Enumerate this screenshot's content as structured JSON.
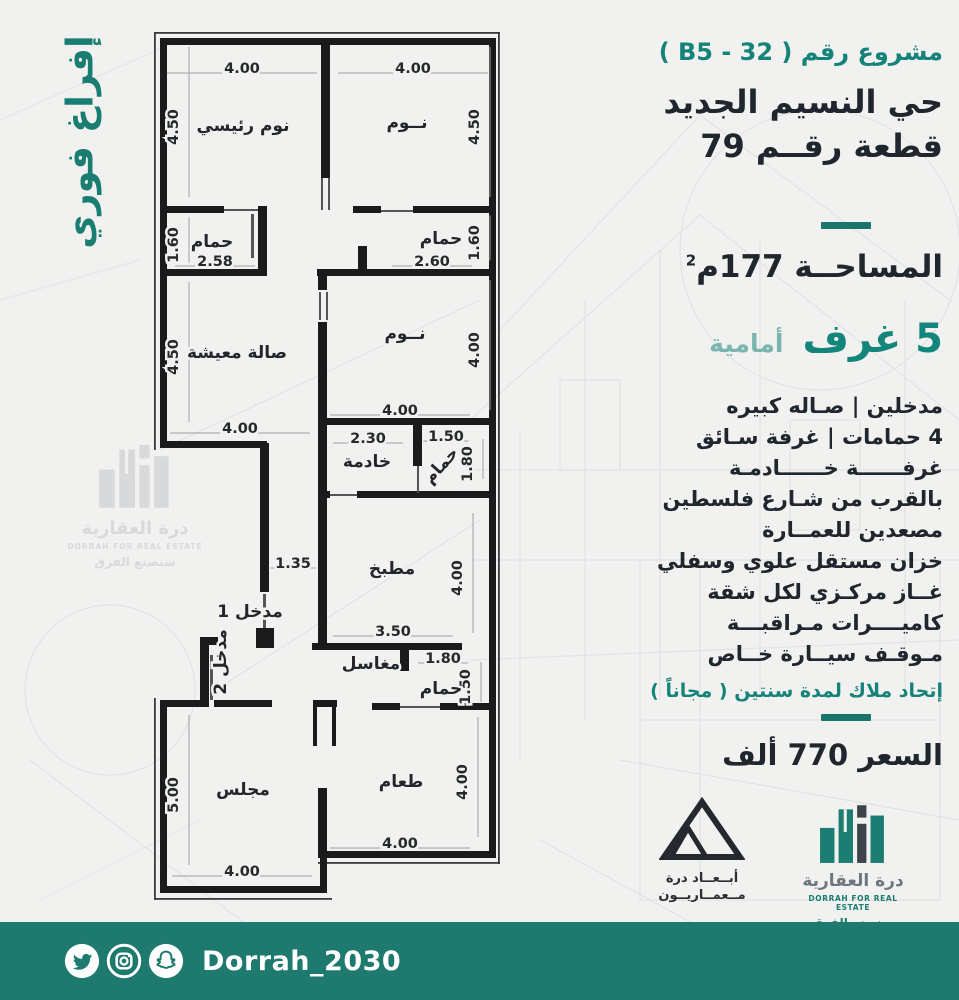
{
  "banner": {
    "text": "إفراغ فوري"
  },
  "panel": {
    "project_no": "مشروع رقم ( B5 - 32 )",
    "district": "حي النسيم الجديد",
    "plot": "قطعة رقــم 79",
    "area": "المساحــة 177م",
    "area_sup": "2",
    "rooms_count": "5 غرف",
    "rooms_side": "أمامية",
    "features": [
      "مدخلين  |  صـاله كبيره",
      "4 حمامات | غرفة سـائق",
      "غرفــــــة خــــــادمـة",
      "بالقرب من شـارع فلسطين",
      "مصعدين  للعمــارة",
      "خزان مستقل علوي وسفلي",
      "غــاز مركـزي لكل شقة",
      "كاميــــرات مـراقبـــة",
      "مـوقـف سيــارة خــاص"
    ],
    "note": "إتحاد ملاك لمدة سنتين ( مجاناً )",
    "price": "السعر 770 ألف"
  },
  "floorplan": {
    "rooms": [
      {
        "label": "نوم رئيسي",
        "x": 243,
        "y": 125,
        "rot": 0
      },
      {
        "label": "نــوم",
        "x": 407,
        "y": 122,
        "rot": 0
      },
      {
        "label": "حمام",
        "x": 212,
        "y": 241,
        "rot": 0
      },
      {
        "label": "حمام",
        "x": 441,
        "y": 238,
        "rot": 0
      },
      {
        "label": "صالة معيشة",
        "x": 237,
        "y": 352,
        "rot": 0
      },
      {
        "label": "نــوم",
        "x": 405,
        "y": 333,
        "rot": 0
      },
      {
        "label": "خادمة",
        "x": 367,
        "y": 461,
        "rot": 0
      },
      {
        "label": "حمام",
        "x": 445,
        "y": 463,
        "rot": -48
      },
      {
        "label": "مطبخ",
        "x": 392,
        "y": 568,
        "rot": 0
      },
      {
        "label": "مدخل 1",
        "x": 250,
        "y": 611,
        "rot": 0
      },
      {
        "label": "مدخل 2",
        "x": 226,
        "y": 656,
        "rot": -90
      },
      {
        "label": "مغاسل",
        "x": 371,
        "y": 663,
        "rot": 0
      },
      {
        "label": "حمام",
        "x": 441,
        "y": 688,
        "rot": 0
      },
      {
        "label": "مجلس",
        "x": 243,
        "y": 789,
        "rot": 0
      },
      {
        "label": "طعام",
        "x": 401,
        "y": 781,
        "rot": 0
      }
    ],
    "dims": [
      {
        "v": "4.00",
        "x": 242,
        "y": 68,
        "rot": 0,
        "len": 150
      },
      {
        "v": "4.00",
        "x": 413,
        "y": 68,
        "rot": 0,
        "len": 150
      },
      {
        "v": "4.50",
        "x": 178,
        "y": 122,
        "rot": -90,
        "len": 150
      },
      {
        "v": "4.50",
        "x": 479,
        "y": 122,
        "rot": -90,
        "len": 150
      },
      {
        "v": "1.60",
        "x": 178,
        "y": 240,
        "rot": -90,
        "len": 45
      },
      {
        "v": "2.58",
        "x": 215,
        "y": 261,
        "rot": 0,
        "len": 80
      },
      {
        "v": "1.60",
        "x": 479,
        "y": 238,
        "rot": -90,
        "len": 45
      },
      {
        "v": "2.60",
        "x": 432,
        "y": 261,
        "rot": 0,
        "len": 80
      },
      {
        "v": "4.50",
        "x": 178,
        "y": 352,
        "rot": -90,
        "len": 140
      },
      {
        "v": "4.00",
        "x": 479,
        "y": 345,
        "rot": -90,
        "len": 130
      },
      {
        "v": "4.00",
        "x": 240,
        "y": 428,
        "rot": 0,
        "len": 140
      },
      {
        "v": "4.00",
        "x": 400,
        "y": 410,
        "rot": 0,
        "len": 140
      },
      {
        "v": "2.30",
        "x": 368,
        "y": 438,
        "rot": 0,
        "len": 70
      },
      {
        "v": "1.50",
        "x": 446,
        "y": 436,
        "rot": 0,
        "len": 45
      },
      {
        "v": "1.80",
        "x": 472,
        "y": 459,
        "rot": -90,
        "len": 40
      },
      {
        "v": "1.35",
        "x": 293,
        "y": 563,
        "rot": 0,
        "len": 45
      },
      {
        "v": "4.00",
        "x": 462,
        "y": 573,
        "rot": -90,
        "len": 120
      },
      {
        "v": "3.50",
        "x": 393,
        "y": 631,
        "rot": 0,
        "len": 120
      },
      {
        "v": "1.80",
        "x": 443,
        "y": 658,
        "rot": 0,
        "len": 50
      },
      {
        "v": "1.50",
        "x": 470,
        "y": 682,
        "rot": -90,
        "len": 40
      },
      {
        "v": "4.00",
        "x": 467,
        "y": 777,
        "rot": -90,
        "len": 120
      },
      {
        "v": "4.00",
        "x": 400,
        "y": 843,
        "rot": 0,
        "len": 140
      },
      {
        "v": "4.00",
        "x": 242,
        "y": 871,
        "rot": 0,
        "len": 140
      },
      {
        "v": "5.00",
        "x": 178,
        "y": 790,
        "rot": -90,
        "len": 150
      }
    ]
  },
  "watermark": {
    "ar": "درة العقارية",
    "en": "DORRAH FOR REAL ESTATE",
    "slogan": "سنصنع الفرق"
  },
  "logos": {
    "abaad": {
      "line1": "أبــعــاد درة",
      "line2": "مــعمــاريــون"
    },
    "dorrah": {
      "ar": "درة العقارية",
      "en": "DORRAH FOR REAL ESTATE",
      "slogan": "سنصنع الفرق"
    }
  },
  "footer": {
    "handle": "Dorrah_2030"
  },
  "colors": {
    "accent_teal": "#1a7d72",
    "teal_bright": "#16837a",
    "teal_light": "#7ab5af",
    "dark_text": "#20262e",
    "footer_bg": "#1e7a6e",
    "wall": "#1b1b1b",
    "background": "#f1f1ef"
  }
}
